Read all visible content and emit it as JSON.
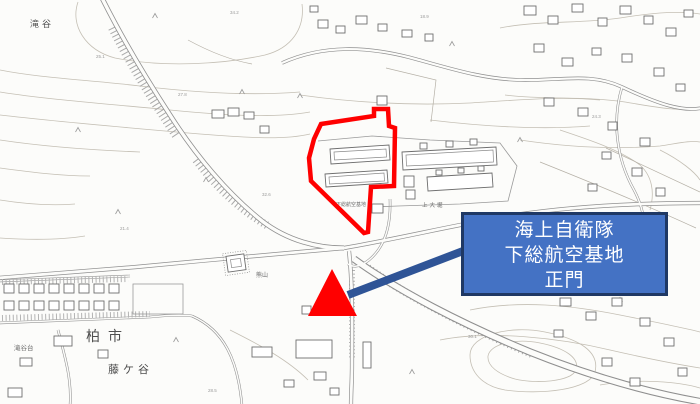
{
  "annotation": {
    "label_box": {
      "lines": [
        "海上自衛隊",
        "下総航空基地",
        "正門"
      ],
      "fill": "#4472c4",
      "border_color": "#1f3864",
      "text_color": "#ffffff"
    },
    "arrow": {
      "color": "#2f5496"
    },
    "marker": {
      "type": "triangle",
      "color": "#ff0000"
    },
    "site_outline": {
      "color": "#ff0000"
    }
  },
  "map": {
    "labels": {
      "takiya": "滝谷",
      "kashiwa_city": "柏市",
      "fujigaya": "藤ケ谷",
      "takiyadai": "滝谷台",
      "shimofusa_base_small": "下総航空基地",
      "kamioobori": "上大堀",
      "kumayama": "熊山"
    },
    "spot_elevations": [
      "34.2",
      "25.1",
      "27.8",
      "21.4",
      "32.6",
      "18.9",
      "24.3",
      "30.1",
      "22.7",
      "28.5"
    ]
  }
}
